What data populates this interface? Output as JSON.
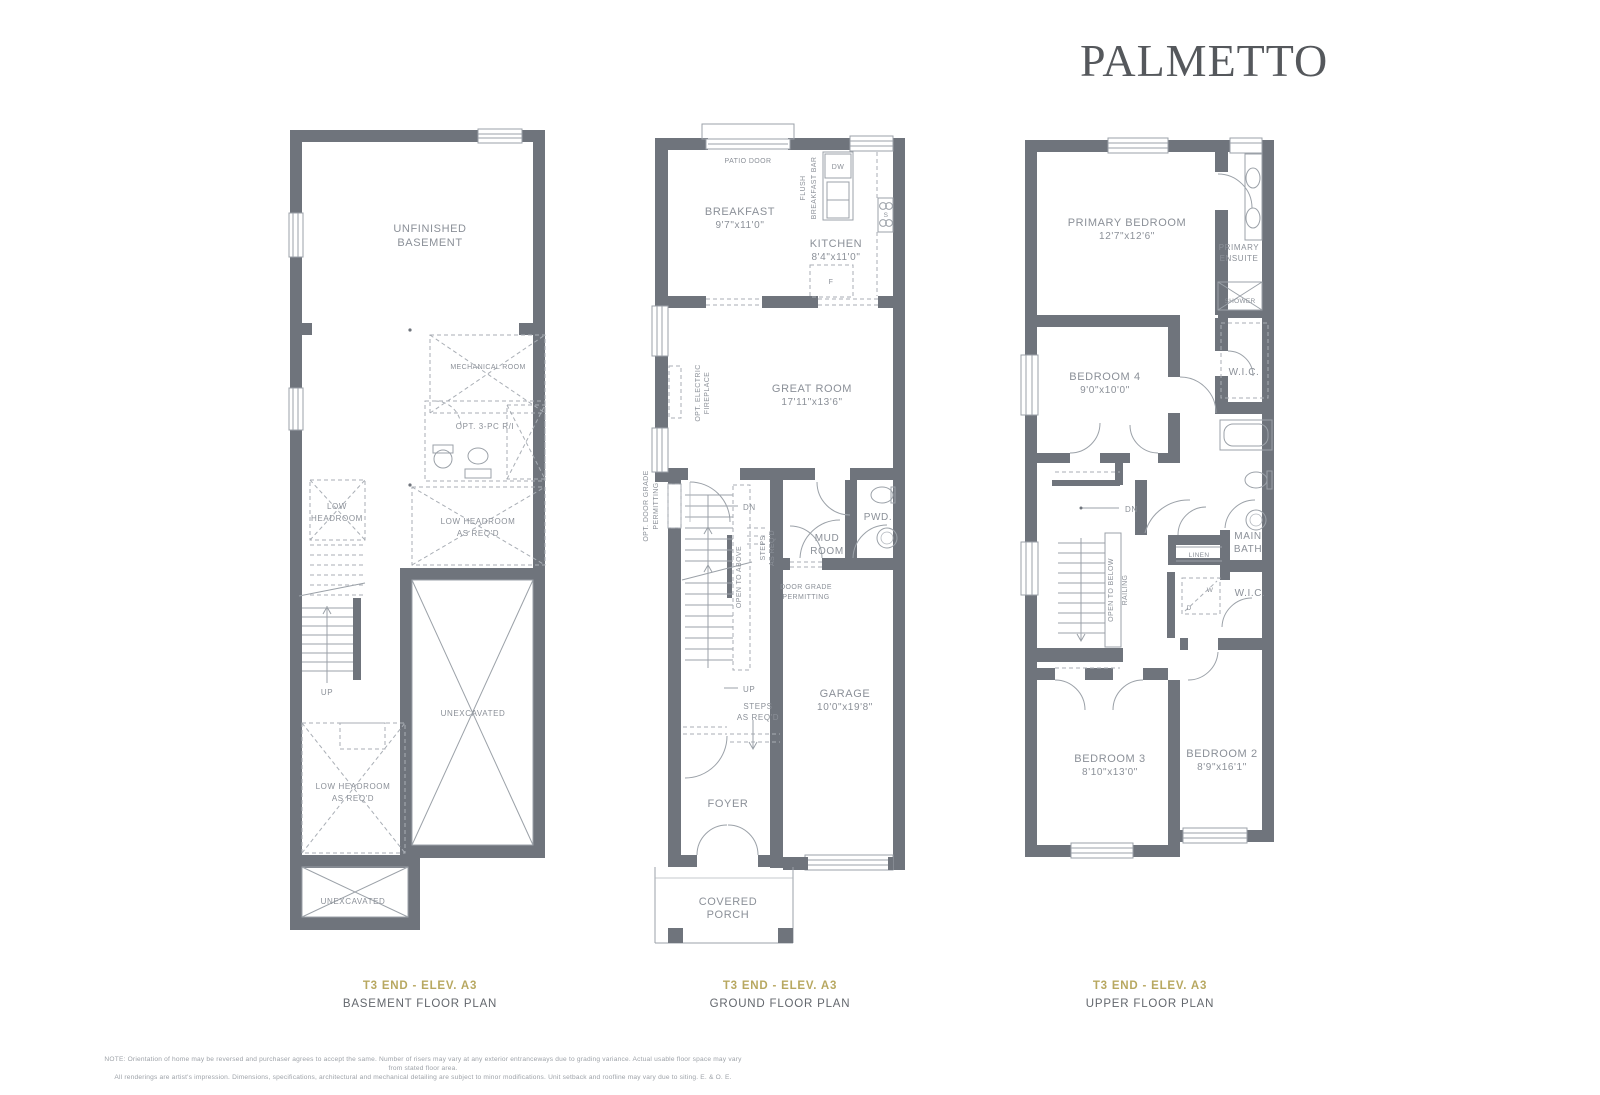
{
  "logo": "PALMETTO",
  "captions": {
    "model": "T3 END - ELEV. A3",
    "basement_name": "BASEMENT FLOOR PLAN",
    "ground_name": "GROUND FLOOR PLAN",
    "upper_name": "UPPER FLOOR PLAN"
  },
  "note": {
    "line1": "NOTE: Orientation of home may be reversed and purchaser agrees to accept the same. Number of risers may vary at any exterior entranceways due to grading variance. Actual usable floor space may vary from stated floor area.",
    "line2": "All renderings are artist's impression. Dimensions, specifications, architectural and mechanical detailing are subject to minor modifications. Unit setback and roofline may vary due to siting. E. & O. E."
  },
  "basement": {
    "unfinished1": "UNFINISHED",
    "unfinished2": "BASEMENT",
    "mechanical": "MECHANICAL ROOM",
    "opt3pc": "OPT. 3-PC R/I",
    "low1": "LOW",
    "low2": "HEADROOM",
    "lowreq1": "LOW HEADROOM",
    "lowreq2": "AS REQ'D",
    "lowreqb1": "LOW HEADROOM",
    "lowreqb2": "AS REQ'D",
    "unexcavated": "UNEXCAVATED",
    "unexcavated_b": "UNEXCAVATED",
    "up": "UP"
  },
  "ground": {
    "patio_door": "PATIO DOOR",
    "breakfast": "BREAKFAST",
    "breakfast_dim": "9'7\"x11'0\"",
    "flush1": "FLUSH",
    "flush2": "BREAKFAST BAR",
    "dw": "DW",
    "kitchen": "KITCHEN",
    "kitchen_dim": "8'4\"x11'0\"",
    "fridge": "F",
    "stove": "S",
    "great_room": "GREAT ROOM",
    "great_room_dim": "17'11\"x13'6\"",
    "fireplace1": "OPT. ELECTRIC",
    "fireplace2": "FIREPLACE",
    "optdoor1": "OPT. DOOR GRADE",
    "optdoor2": "PERMITTING",
    "dn": "DN",
    "up": "UP",
    "open_above": "OPEN TO ABOVE",
    "steps_v1": "STEPS",
    "steps_v2": "AS REQ'D",
    "steps_h1": "STEPS",
    "steps_h2": "AS REQ'D",
    "mud1": "MUD",
    "mud2": "ROOM",
    "pwd": "PWD.",
    "door_grade1": "DOOR GRADE",
    "door_grade2": "PERMITTING",
    "garage": "GARAGE",
    "garage_dim": "10'0\"x19'8\"",
    "foyer": "FOYER",
    "porch1": "COVERED",
    "porch2": "PORCH"
  },
  "upper": {
    "primary": "PRIMARY BEDROOM",
    "primary_dim": "12'7\"x12'6\"",
    "ensuite1": "PRIMARY",
    "ensuite2": "ENSUITE",
    "shower": "SHOWER",
    "bedroom4": "BEDROOM 4",
    "bedroom4_dim": "9'0\"x10'0\"",
    "wic1": "W.I.C.",
    "dn": "DN",
    "open_below": "OPEN TO BELOW",
    "railing": "RAILING",
    "main1": "MAIN",
    "main2": "BATH",
    "linen": "LINEN",
    "washer": "W",
    "dryer": "D",
    "wic2": "W.I.C.",
    "bedroom3": "BEDROOM 3",
    "bedroom3_dim": "8'10\"x13'0\"",
    "bedroom2": "BEDROOM 2",
    "bedroom2_dim": "8'9\"x16'1\""
  }
}
